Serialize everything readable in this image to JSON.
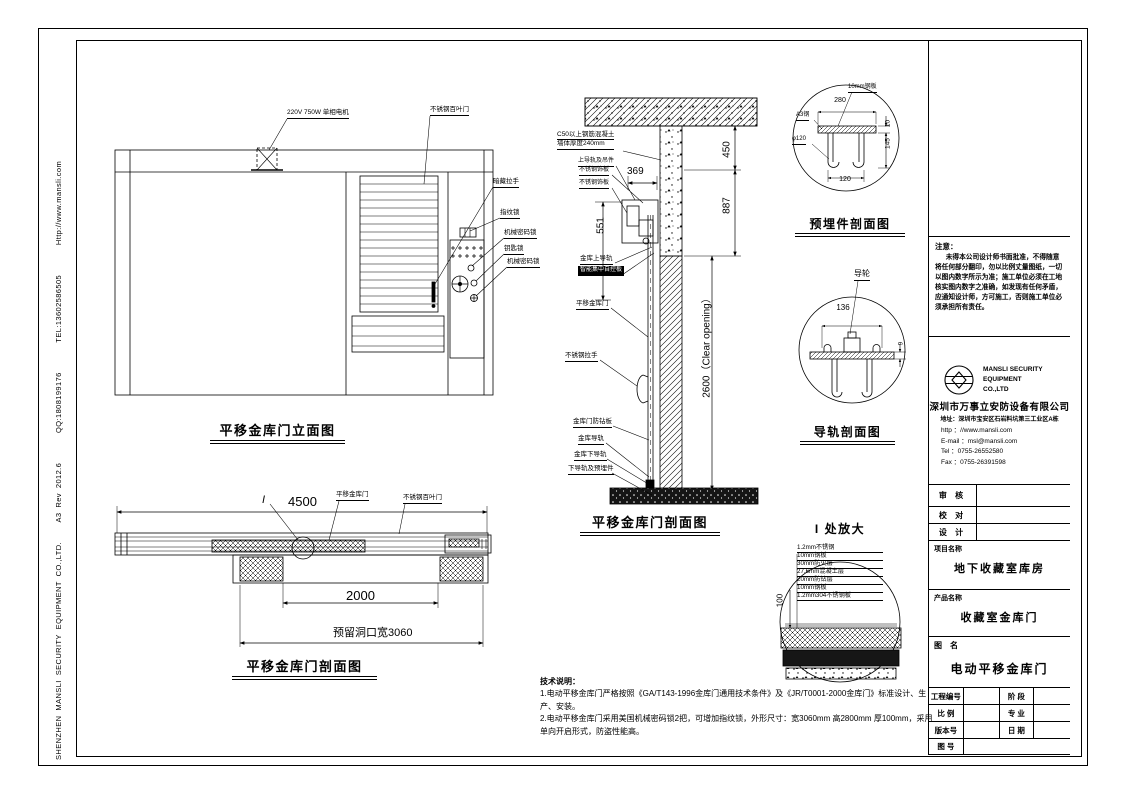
{
  "frame": {
    "side_strip": "SHENZHEN  MANSLI  SECURITY  EQUIPMENT  CO.,LTD.        A3  Rev  2012.6            QQ:1808199176            TEL:13602586505            Http://www.mansli.com"
  },
  "elevation": {
    "title": "平移金库门立面图",
    "motor_label": "220V 750W 单相电机",
    "louver_label": "不锈钢百叶门",
    "hidden_handle_label": "暗藏拉手",
    "fingerprint_label": "指纹锁",
    "mech_lock_label": "机械密码锁",
    "key_lock_label": "钥匙锁",
    "mech_lock2_label": "机械密码锁"
  },
  "section": {
    "title": "平移金库门剖面图",
    "concrete_label_1": "C50以上钢筋混凝土",
    "concrete_label_2": "墙体厚度240mm",
    "upper_rail_label": "上导轨及吊件",
    "ss_plate_label_1": "不锈钢饰板",
    "ss_plate_label_2": "不锈钢饰板",
    "vault_upper_rail_label": "金库上导轨",
    "control_board_label": "智能集中自控板",
    "door_label": "平移金库门",
    "handle_label": "不锈钢拉手",
    "anti_drill_label": "金库门防钻板",
    "rail_label": "金库导轨",
    "lower_rail_label": "金库下导轨",
    "embed_label": "下导轨及预埋件",
    "dim_450": "450",
    "dim_887": "887",
    "dim_369": "369",
    "dim_551": "551",
    "dim_clear": "2600（Clear opening）"
  },
  "plan": {
    "title": "平移金库门剖面图",
    "marker": "I",
    "dim_4500": "4500",
    "door_label": "平移金库门",
    "louver_label": "不锈钢百叶门",
    "dim_2000": "2000",
    "dim_opening": "预留洞口宽3060"
  },
  "embed_detail": {
    "title": "预埋件剖面图",
    "plate_label": "10mm钢板",
    "steel_label": "A3钢",
    "phi_label": "φ120",
    "dim_280": "280",
    "dim_10": "10",
    "dim_145": "145",
    "dim_120": "120"
  },
  "rail_detail": {
    "title": "导轨剖面图",
    "wheel_label": "导轮",
    "dim_136": "136",
    "dim_9": "9"
  },
  "enlarge_detail": {
    "title": "I 处放大",
    "dim_100": "100",
    "layers": [
      "1.2mm不锈钢",
      "10mm钢板",
      "30mm防火层",
      "27.6mm混凝土层",
      "20mm防钻层",
      "10mm钢板",
      "1.2mm304不锈钢板"
    ]
  },
  "tech_notes": {
    "heading": "技术说明：",
    "line1": "1.电动平移金库门严格按照《GA/T143-1996金库门通用技术条件》及《JR/T0001-2000金库门》标准设计、生产、安装。",
    "line2": "2.电动平移金库门采用美国机械密码锁2把，可增加指纹锁，外形尺寸：宽3060mm 高2800mm 厚100mm，采用单向开启形式，防盗性能高。"
  },
  "title_block": {
    "notice_title": "注意：",
    "notice_body": "未得本公司设计师书面批准，不得随意将任何部分翻印，勿以比例丈量图纸，一切以图内数字所示为准；施工单位必须在工地核实图内数字之准确，如发现有任何矛盾，应通知设计师，方可施工，否则施工单位必须承担所有责任。",
    "logo_en_1": "MANSLI SECURITY",
    "logo_en_2": "EQUIPMENT",
    "logo_en_3": "CO.,LTD",
    "company_cn": "深圳市万事立安防设备有限公司",
    "address": "地址：深圳市宝安区石岩料坑第三工业区A栋",
    "http": "http ：//www.mansli.com",
    "email": "E-mail ：msl@mansli.com",
    "tel": "Tel ：0755-26552580",
    "fax": "Fax ：0755-26391598",
    "review": "审 核",
    "proof": "校 对",
    "design": "设 计",
    "project_label": "项目名称",
    "project_value": "地下收藏室库房",
    "product_label": "产品名称",
    "product_value": "收藏室金库门",
    "drawing_label": "图　名",
    "drawing_value": "电动平移金库门",
    "eng_no": "工程编号",
    "stage": "阶 段",
    "scale": "比 例",
    "major": "专 业",
    "version": "版本号",
    "date": "日 期",
    "fig_no": "图 号"
  }
}
